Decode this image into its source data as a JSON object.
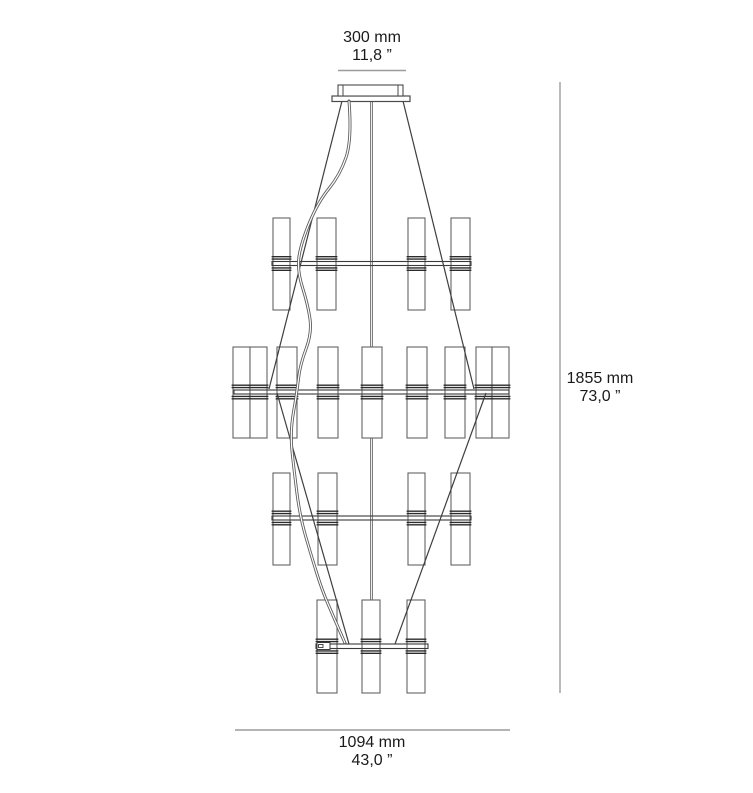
{
  "page": {
    "background": "#ffffff",
    "description": "Technical dimension drawing of a four-tier chandelier, front elevation"
  },
  "colors": {
    "line_art": "#4a4a4a",
    "cable": "#3f3f3f",
    "cylinder_stroke": "#636363",
    "band": "#2b2b2b",
    "arm": "#3a3a3a",
    "cord": "#5d5d5d",
    "dimension_line": "#9c9c9c",
    "text": "#1a1a1a"
  },
  "dimensions": {
    "top": {
      "mm": "300 mm",
      "inch": "11,8 ”"
    },
    "right": {
      "mm": "1855 mm",
      "inch": "73,0 ”"
    },
    "bottom": {
      "mm": "1094 mm",
      "inch": "43,0 ”"
    }
  },
  "drawing": {
    "dim_lines": {
      "top": {
        "x1": 338,
        "x2": 406,
        "y": 70.5
      },
      "right": {
        "x": 560,
        "y1": 82,
        "y2": 693
      },
      "bottom": {
        "x1": 235,
        "x2": 510,
        "y": 730
      }
    },
    "canopy": {
      "plate": [
        332,
        96,
        78,
        5.5
      ],
      "box": [
        338,
        85,
        65,
        11
      ],
      "inner_lines_x": [
        343,
        398
      ]
    },
    "stem": {
      "x": 371.5,
      "y1": 101,
      "y2": 600
    },
    "cables": [
      [
        [
          342,
          101
        ],
        [
          269,
          389
        ]
      ],
      [
        [
          277,
          393
        ],
        [
          349,
          644
        ]
      ],
      [
        [
          403,
          101
        ],
        [
          474,
          389
        ]
      ],
      [
        [
          486,
          393
        ],
        [
          395,
          644
        ]
      ]
    ],
    "cord_points": [
      [
        349,
        101
      ],
      [
        352,
        140
      ],
      [
        340,
        175
      ],
      [
        318,
        202
      ],
      [
        301,
        243
      ],
      [
        297,
        270
      ],
      [
        308,
        305
      ],
      [
        312,
        333
      ],
      [
        300,
        365
      ],
      [
        297,
        392
      ],
      [
        290,
        432
      ],
      [
        294,
        470
      ],
      [
        300,
        517
      ],
      [
        312,
        558
      ],
      [
        322,
        590
      ],
      [
        334,
        618
      ],
      [
        345,
        643
      ]
    ],
    "tiers": [
      {
        "arm": {
          "x1": 272,
          "x2": 471,
          "y": 261.5,
          "h": 4
        },
        "cyl_top": 218,
        "cyl_bottom": 310,
        "cylinders": [
          [
            273,
            290
          ],
          [
            317,
            336
          ],
          [
            408,
            425
          ],
          [
            451,
            470
          ]
        ]
      },
      {
        "arm": {
          "x1": 234,
          "x2": 509,
          "y": 390,
          "h": 4
        },
        "cyl_top": 347,
        "cyl_bottom": 438,
        "cylinders": [
          [
            233,
            250
          ],
          [
            250,
            267
          ],
          [
            277,
            297
          ],
          [
            318,
            338
          ],
          [
            362,
            382
          ],
          [
            407,
            427
          ],
          [
            445,
            465
          ],
          [
            476,
            492
          ],
          [
            492,
            509
          ]
        ]
      },
      {
        "arm": {
          "x1": 272,
          "x2": 471,
          "y": 516,
          "h": 4
        },
        "cyl_top": 473,
        "cyl_bottom": 565,
        "cylinders": [
          [
            273,
            290
          ],
          [
            318,
            337
          ],
          [
            408,
            425
          ],
          [
            451,
            470
          ]
        ]
      },
      {
        "arm": {
          "x1": 316,
          "x2": 428,
          "y": 644,
          "h": 4.5
        },
        "cyl_top": 600,
        "cyl_bottom": 693,
        "cylinders": [
          [
            317,
            337
          ],
          [
            362,
            380
          ],
          [
            407,
            425
          ]
        ],
        "connector": [
          317,
          642.5,
          13,
          7
        ],
        "connector_inner": [
          318.5,
          644.5,
          4.5,
          3
        ]
      }
    ]
  }
}
